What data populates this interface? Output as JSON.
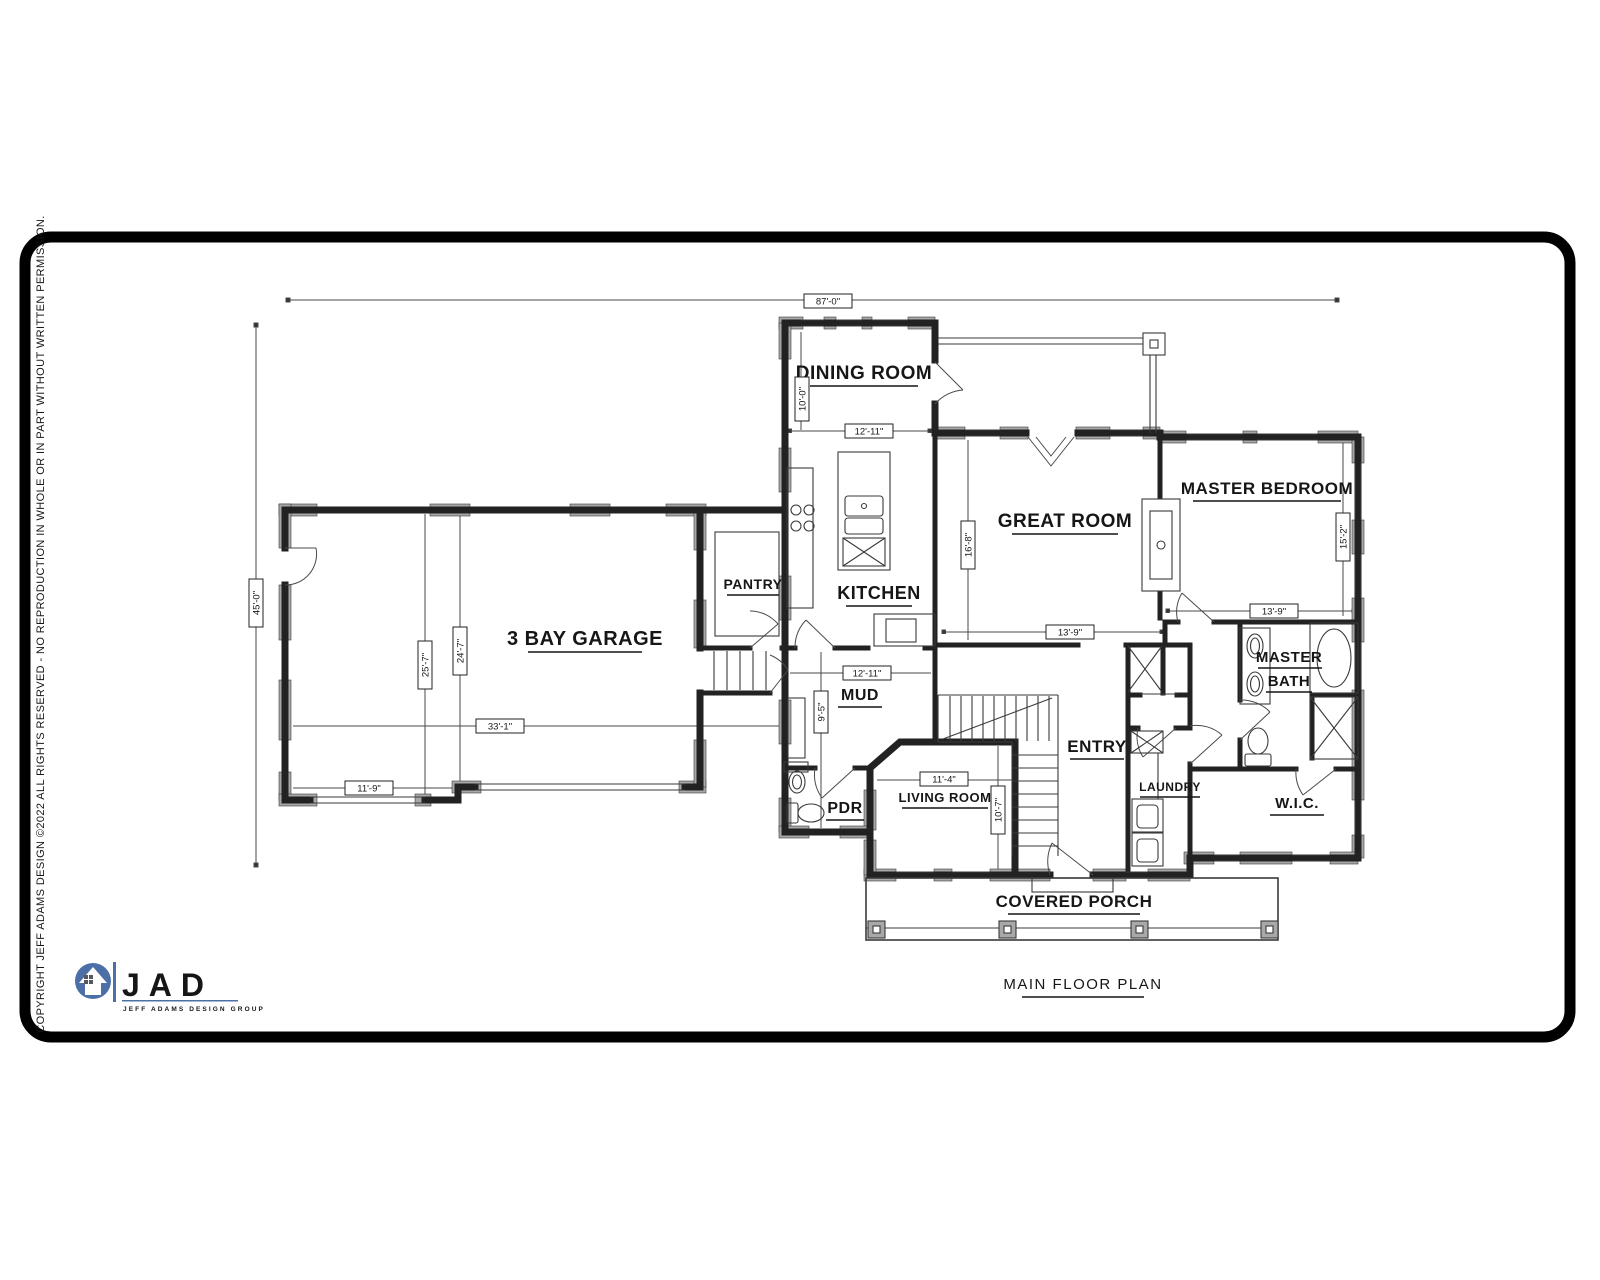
{
  "page": {
    "bg": "#ffffff",
    "ink": "#1c1c1c",
    "poche": "#a8a8a8"
  },
  "titleblock": {
    "plan_title": "MAIN FLOOR PLAN",
    "copyright": "COPYRIGHT JEFF ADAMS DESIGN ©2022 ALL RIGHTS RESERVED - NO REPRODUCTION IN WHOLE OR IN PART WITHOUT WRITTEN PERMISSION."
  },
  "logo": {
    "initials": "JAD",
    "tagline": "JEFF ADAMS DESIGN GROUP",
    "color": "#4c6fa8"
  },
  "rooms": [
    {
      "label": "DINING ROOM"
    },
    {
      "label": "KITCHEN"
    },
    {
      "label": "PANTRY"
    },
    {
      "label": "3 BAY GARAGE"
    },
    {
      "label": "GREAT ROOM"
    },
    {
      "label": "MASTER BEDROOM"
    },
    {
      "label": "MASTER"
    },
    {
      "label": "BATH"
    },
    {
      "label": "MUD"
    },
    {
      "label": "ENTRY"
    },
    {
      "label": "LIVING ROOM"
    },
    {
      "label": "PDR"
    },
    {
      "label": "LAUNDRY"
    },
    {
      "label": "W.I.C."
    },
    {
      "label": "COVERED PORCH"
    }
  ],
  "dimensions": [
    {
      "label": "87'-0\""
    },
    {
      "label": "45'-0\""
    },
    {
      "label": "10'-0\""
    },
    {
      "label": "12'-11\""
    },
    {
      "label": "16'-8\""
    },
    {
      "label": "13'-9\""
    },
    {
      "label": "13'-9\""
    },
    {
      "label": "15'-2\""
    },
    {
      "label": "33'-1\""
    },
    {
      "label": "25'-7\""
    },
    {
      "label": "24'-7\""
    },
    {
      "label": "11'-9\""
    },
    {
      "label": "12'-11\""
    },
    {
      "label": "9'-5\""
    },
    {
      "label": "11'-4\""
    },
    {
      "label": "10'-7\""
    }
  ]
}
